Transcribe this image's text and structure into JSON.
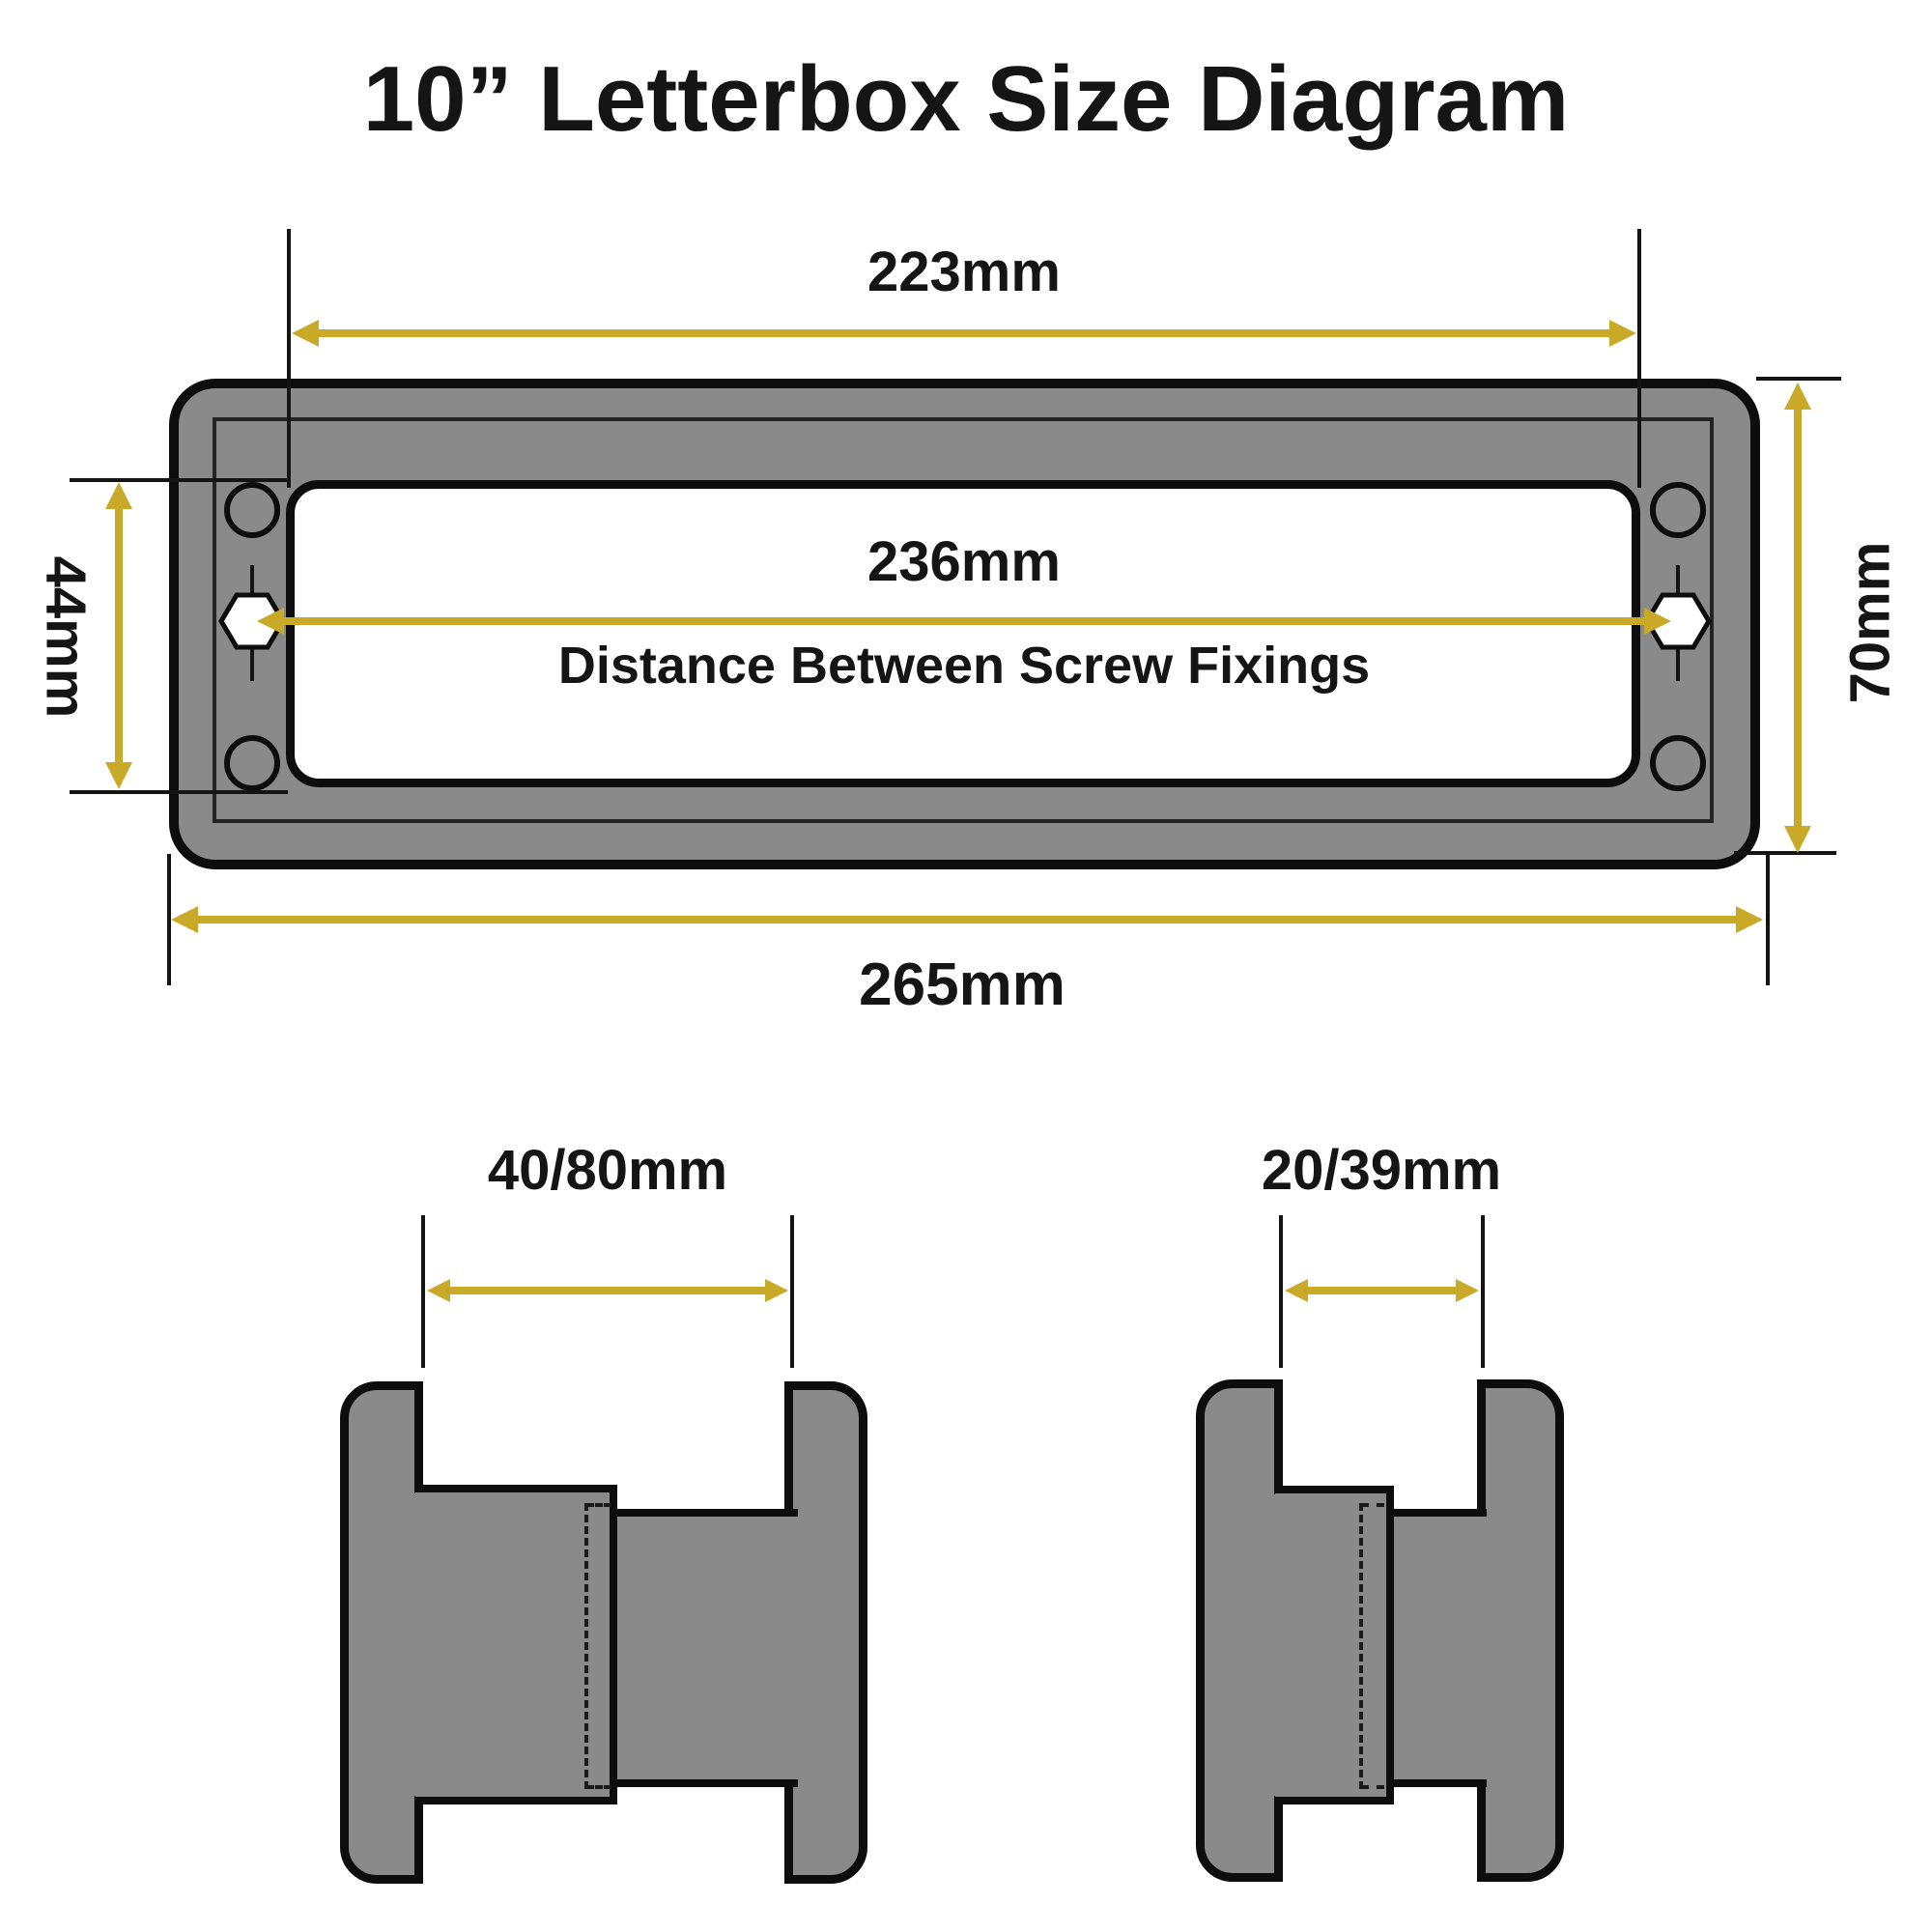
{
  "title": "10” Letterbox Size Diagram",
  "colors": {
    "dimension_gold": "#c9aa28",
    "body_gray": "#8a8a8a",
    "outline_black": "#0d0d0d",
    "background": "#ffffff",
    "text": "#151515"
  },
  "front_view": {
    "aperture_width": "223mm",
    "fixings_distance": "236mm",
    "fixings_caption": "Distance Between Screw Fixings",
    "holes_height": "44mm",
    "overall_height": "70mm",
    "overall_width": "265mm"
  },
  "side_views": {
    "left": {
      "label": "40/80mm"
    },
    "right": {
      "label": "20/39mm"
    }
  }
}
